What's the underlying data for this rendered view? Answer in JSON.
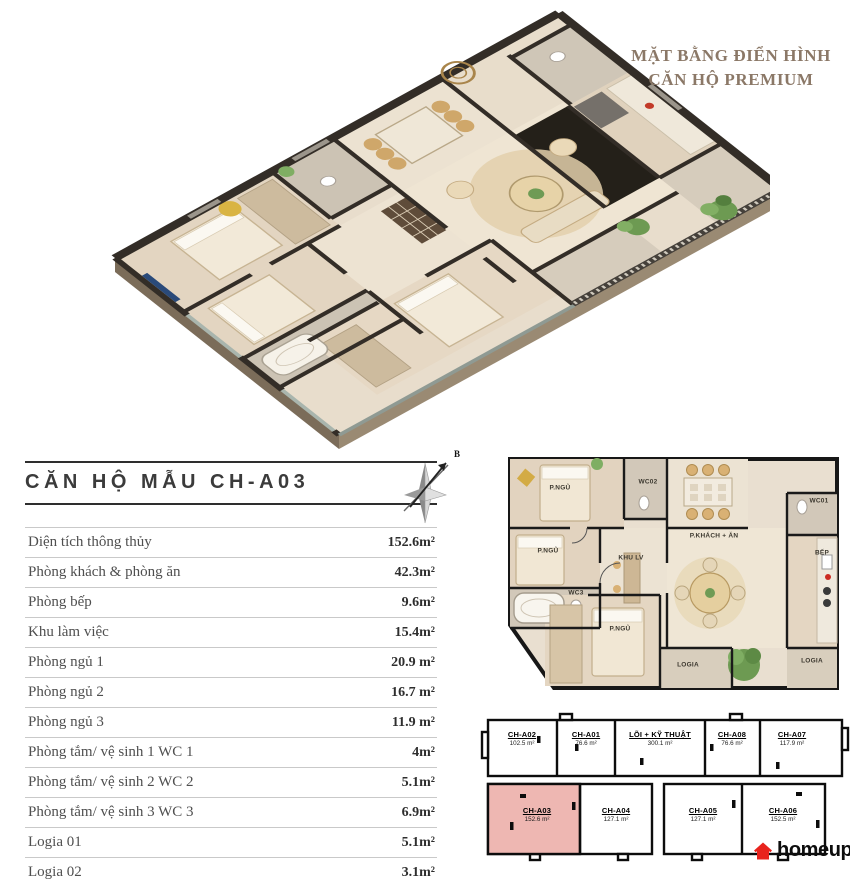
{
  "page_title": {
    "line1": "MẶT BẰNG ĐIỂN HÌNH",
    "line2": "CĂN HỘ PREMIUM"
  },
  "unit_section": {
    "heading": "CĂN HỘ MẪU CH-A03",
    "compass_label": "B",
    "rows": [
      {
        "label": "Diện tích thông thủy",
        "value": "152.6m²"
      },
      {
        "label": "Phòng khách & phòng ăn",
        "value": "42.3m²"
      },
      {
        "label": "Phòng bếp",
        "value": "9.6m²"
      },
      {
        "label": "Khu làm việc",
        "value": "15.4m²"
      },
      {
        "label": "Phòng ngủ 1",
        "value": "20.9 m²"
      },
      {
        "label": "Phòng ngủ 2",
        "value": "16.7 m²"
      },
      {
        "label": "Phòng ngủ 3",
        "value": "11.9 m²"
      },
      {
        "label": "Phòng tắm/ vệ sinh 1 WC 1",
        "value": "4m²"
      },
      {
        "label": "Phòng tắm/ vệ sinh 2 WC 2",
        "value": "5.1m²"
      },
      {
        "label": "Phòng tắm/ vệ sinh 3 WC 3",
        "value": "6.9m²"
      },
      {
        "label": "Logia 01",
        "value": "5.1m²"
      },
      {
        "label": "Logia 02",
        "value": "3.1m²"
      }
    ]
  },
  "plan2d": {
    "rooms": {
      "bedroom1": "P.NGỦ",
      "bedroom2": "P.NGỦ",
      "bedroom3": "P.NGỦ",
      "wc01": "WC01",
      "wc02": "WC02",
      "wc03": "WC3",
      "living_dining": "P.KHÁCH + ĂN",
      "work_area": "KHU LV",
      "kitchen": "BẾP",
      "logia1": "LOGIA",
      "logia2": "LOGIA"
    }
  },
  "keyplan": {
    "units": [
      {
        "id": "CH-A02",
        "area": "102.5 m²"
      },
      {
        "id": "CH-A01",
        "area": "76.6 m²"
      },
      {
        "id": "LÕI + KỸ THUẬT",
        "area": "300.1 m²"
      },
      {
        "id": "CH-A08",
        "area": "76.6 m²"
      },
      {
        "id": "CH-A07",
        "area": "117.9 m²"
      },
      {
        "id": "CH-A03",
        "area": "152.6 m²"
      },
      {
        "id": "CH-A04",
        "area": "127.1 m²"
      },
      {
        "id": "CH-A05",
        "area": "127.1 m²"
      },
      {
        "id": "CH-A06",
        "area": "152.5 m²"
      }
    ],
    "highlighted_unit": "CH-A03"
  },
  "logo": {
    "text": "homeup"
  },
  "colors": {
    "title_bronze": "#8b7867",
    "highlight_pink": "#eeb7b2",
    "logo_red": "#e8231d",
    "wall_dark": "#332d27"
  }
}
